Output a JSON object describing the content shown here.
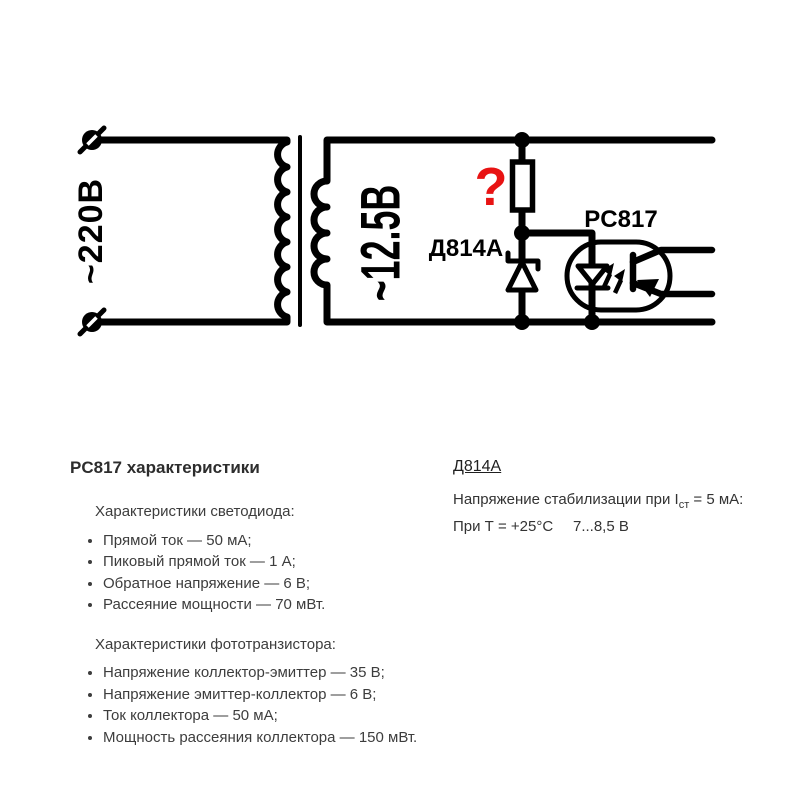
{
  "schematic": {
    "primary_voltage_label": "~220В",
    "secondary_voltage_label": "~12.5В",
    "question_mark": "?",
    "zener_label": "Д814А",
    "optocoupler_label": "PC817",
    "colors": {
      "wire": "#000000",
      "question_red": "#e81313",
      "background": "#ffffff"
    }
  },
  "pc817_section": {
    "title": "PC817 характеристики",
    "led_heading": "Характеристики светодиода:",
    "led_items": [
      "Прямой ток — 50 мА;",
      "Пиковый прямой ток — 1 А;",
      "Обратное напряжение — 6 В;",
      "Рассеяние мощности — 70 мВт."
    ],
    "phototransistor_heading": "Характеристики фототранзистора:",
    "phototransistor_items": [
      "Напряжение коллектор-эмиттер — 35 В;",
      "Напряжение эмиттер-коллектор — 6 В;",
      "Ток коллектора — 50 мА;",
      "Мощность рассеяния коллектора — 150 мВт."
    ]
  },
  "d814a_section": {
    "title": "Д814А",
    "stabilization_prefix": "Напряжение стабилизации при I",
    "stabilization_subscript": "ст",
    "stabilization_suffix": " = 5 мА:",
    "condition_label": "При Т = +25°С",
    "condition_value": "7...8,5 В"
  }
}
